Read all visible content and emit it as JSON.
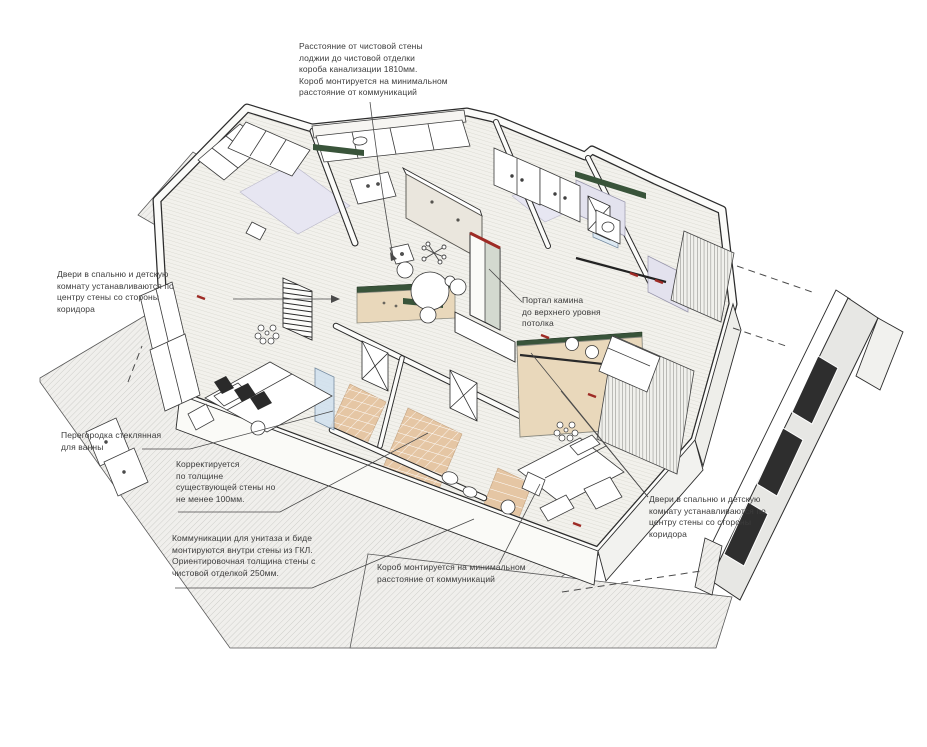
{
  "drawing_title": "Axonometric cutaway floor plan with construction notes",
  "annotations": {
    "duct_top": {
      "text": "Расстояние от чистовой стены\nлоджии до чистовой отделки\nкороба канализации 1810мм.\nКороб монтируется на минимальном\nрасстояние от коммуникаций"
    },
    "doors_left": {
      "text": "Двери в спальню и детскую\nкомнату устанавливаются по\nцентру стены со стороны\nкоридора"
    },
    "fireplace": {
      "text": "Портал камина\nдо верхнего уровня\nпотолка"
    },
    "glass_partition": {
      "text": "Перегородка стеклянная\nдля ванны"
    },
    "wall_thickness": {
      "text": "Корректируется\nпо толщине\nсуществующей стены но\nне менее 100мм."
    },
    "wc_comms": {
      "text": "Коммуникации для унитаза и биде\nмонтируются внутри стены из ГКЛ.\nОриентировочная толщина стены с\nчистовой отделкой 250мм."
    },
    "duct_bottom": {
      "text": "Короб монтируется на минимальном\nрасстояние от коммуникаций"
    },
    "doors_right": {
      "text": "Двери в спальню и детскую\nкомнату устанавливаются по\nцентру стены со стороны\nкоридора"
    }
  },
  "colors": {
    "ink": "#3c3c3c",
    "wall_outline": "#2b2b2b",
    "accent_beige_wall": "#e9d8bb",
    "accent_green_strip": "#39543a",
    "accent_red_mark": "#9e2b25",
    "floor_wood": "#f2f1ec",
    "floor_tile_tan": "#e5c6a4",
    "floor_lavender": "#e7e6f2",
    "podium_hatch": "#c8c7c3",
    "glass_blue": "#cfe0ef"
  }
}
